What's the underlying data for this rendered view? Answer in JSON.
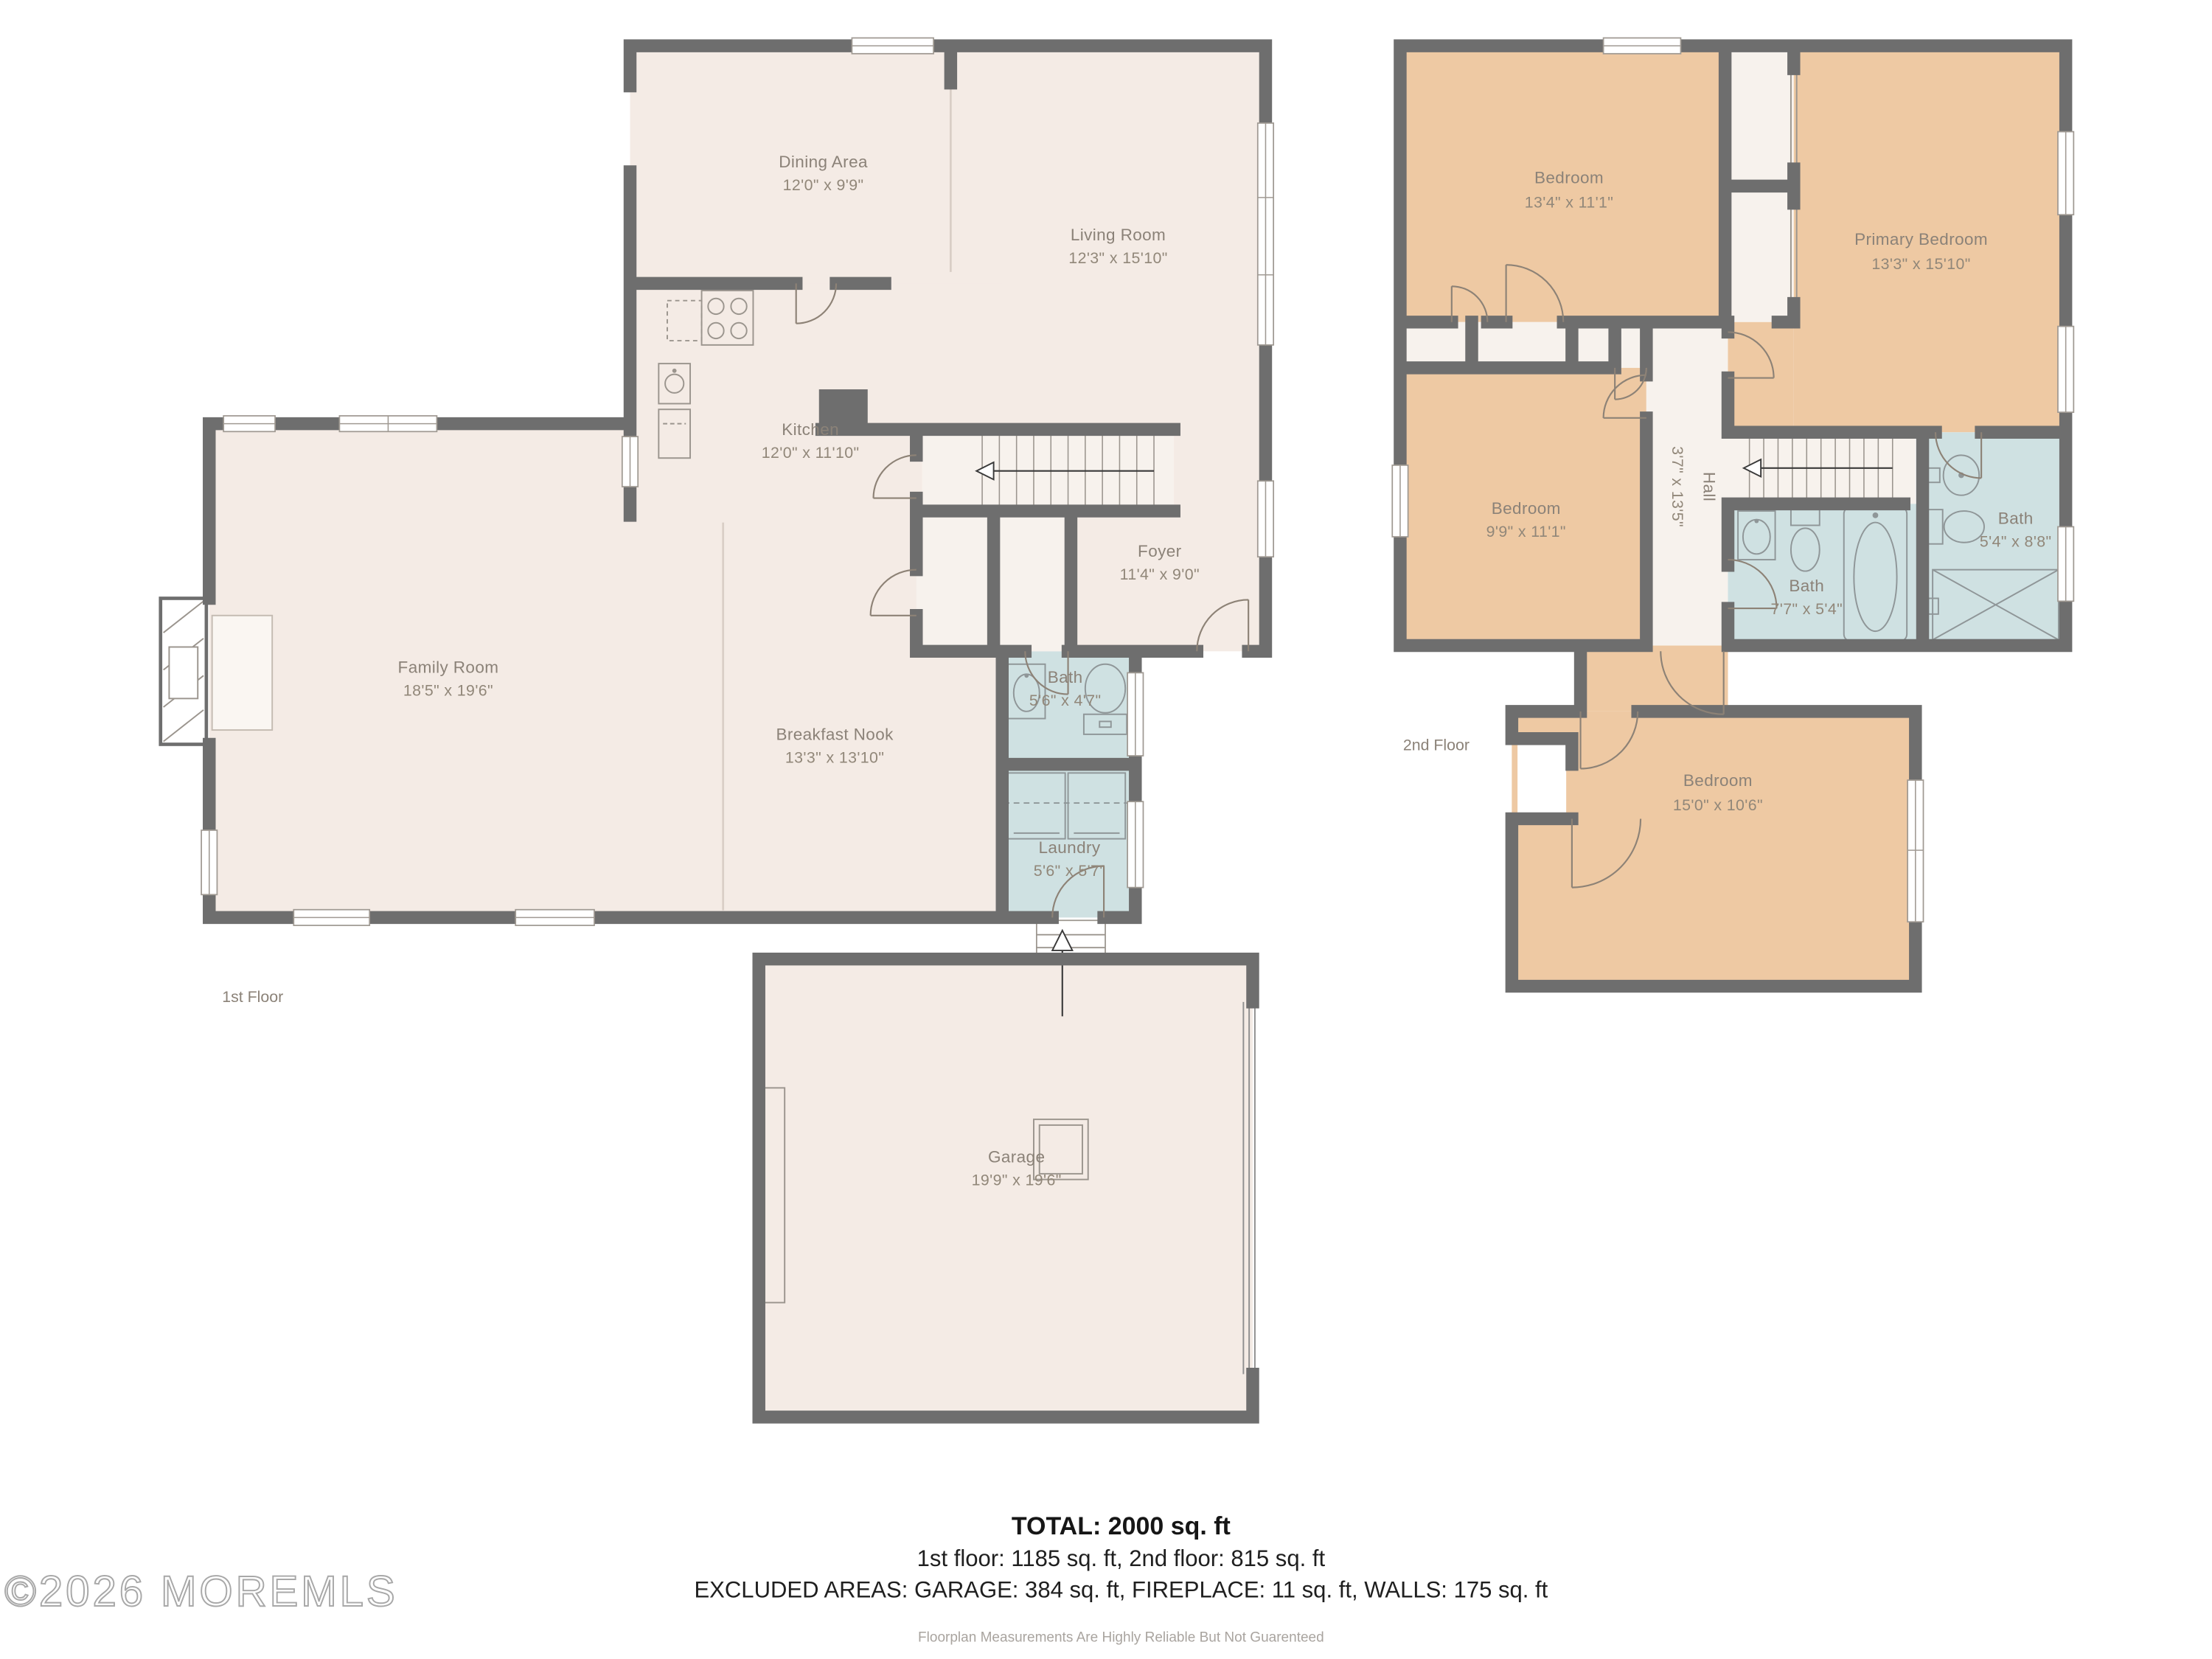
{
  "watermark": "©2026 MOREMLS",
  "floors": {
    "first": {
      "label": "1st Floor",
      "rooms": {
        "dining": {
          "name": "Dining Area",
          "dims": "12'0\" x 9'9\""
        },
        "living": {
          "name": "Living Room",
          "dims": "12'3\" x 15'10\""
        },
        "kitchen": {
          "name": "Kitchen",
          "dims": "12'0\" x 11'10\""
        },
        "foyer": {
          "name": "Foyer",
          "dims": "11'4\" x 9'0\""
        },
        "family": {
          "name": "Family Room",
          "dims": "18'5\" x 19'6\""
        },
        "breakfast": {
          "name": "Breakfast Nook",
          "dims": "13'3\" x 13'10\""
        },
        "bath": {
          "name": "Bath",
          "dims": "5'6\" x 4'7\""
        },
        "laundry": {
          "name": "Laundry",
          "dims": "5'6\" x 5'7\""
        },
        "garage": {
          "name": "Garage",
          "dims": "19'9\" x 19'6\""
        }
      }
    },
    "second": {
      "label": "2nd Floor",
      "rooms": {
        "bedroom_top": {
          "name": "Bedroom",
          "dims": "13'4\" x 11'1\""
        },
        "primary": {
          "name": "Primary Bedroom",
          "dims": "13'3\" x 15'10\""
        },
        "bedroom_mid": {
          "name": "Bedroom",
          "dims": "9'9\" x 11'1\""
        },
        "hall": {
          "name": "Hall",
          "dims": "3'7\" x 13'5\""
        },
        "bath_hall": {
          "name": "Bath",
          "dims": "7'7\" x 5'4\""
        },
        "bath_primary": {
          "name": "Bath",
          "dims": "5'4\" x 8'8\""
        },
        "bedroom_bottom": {
          "name": "Bedroom",
          "dims": "15'0\" x 10'6\""
        }
      }
    }
  },
  "summary": {
    "total": "TOTAL: 2000 sq. ft",
    "floor_breakdown": "1st floor: 1185 sq. ft, 2nd floor: 815 sq. ft",
    "excluded": "EXCLUDED AREAS: GARAGE: 384 sq. ft, FIREPLACE: 11 sq. ft, WALLS: 175 sq. ft",
    "disclaimer": "Floorplan Measurements Are Highly Reliable But Not Guarenteed"
  },
  "colors": {
    "wall": "#6e6e6e",
    "floor": "#f4ebe5",
    "bedroom": "#eec9a3",
    "bath": "#cfe1e2",
    "closet": "#f7f2ed",
    "label": "#8b8278"
  }
}
